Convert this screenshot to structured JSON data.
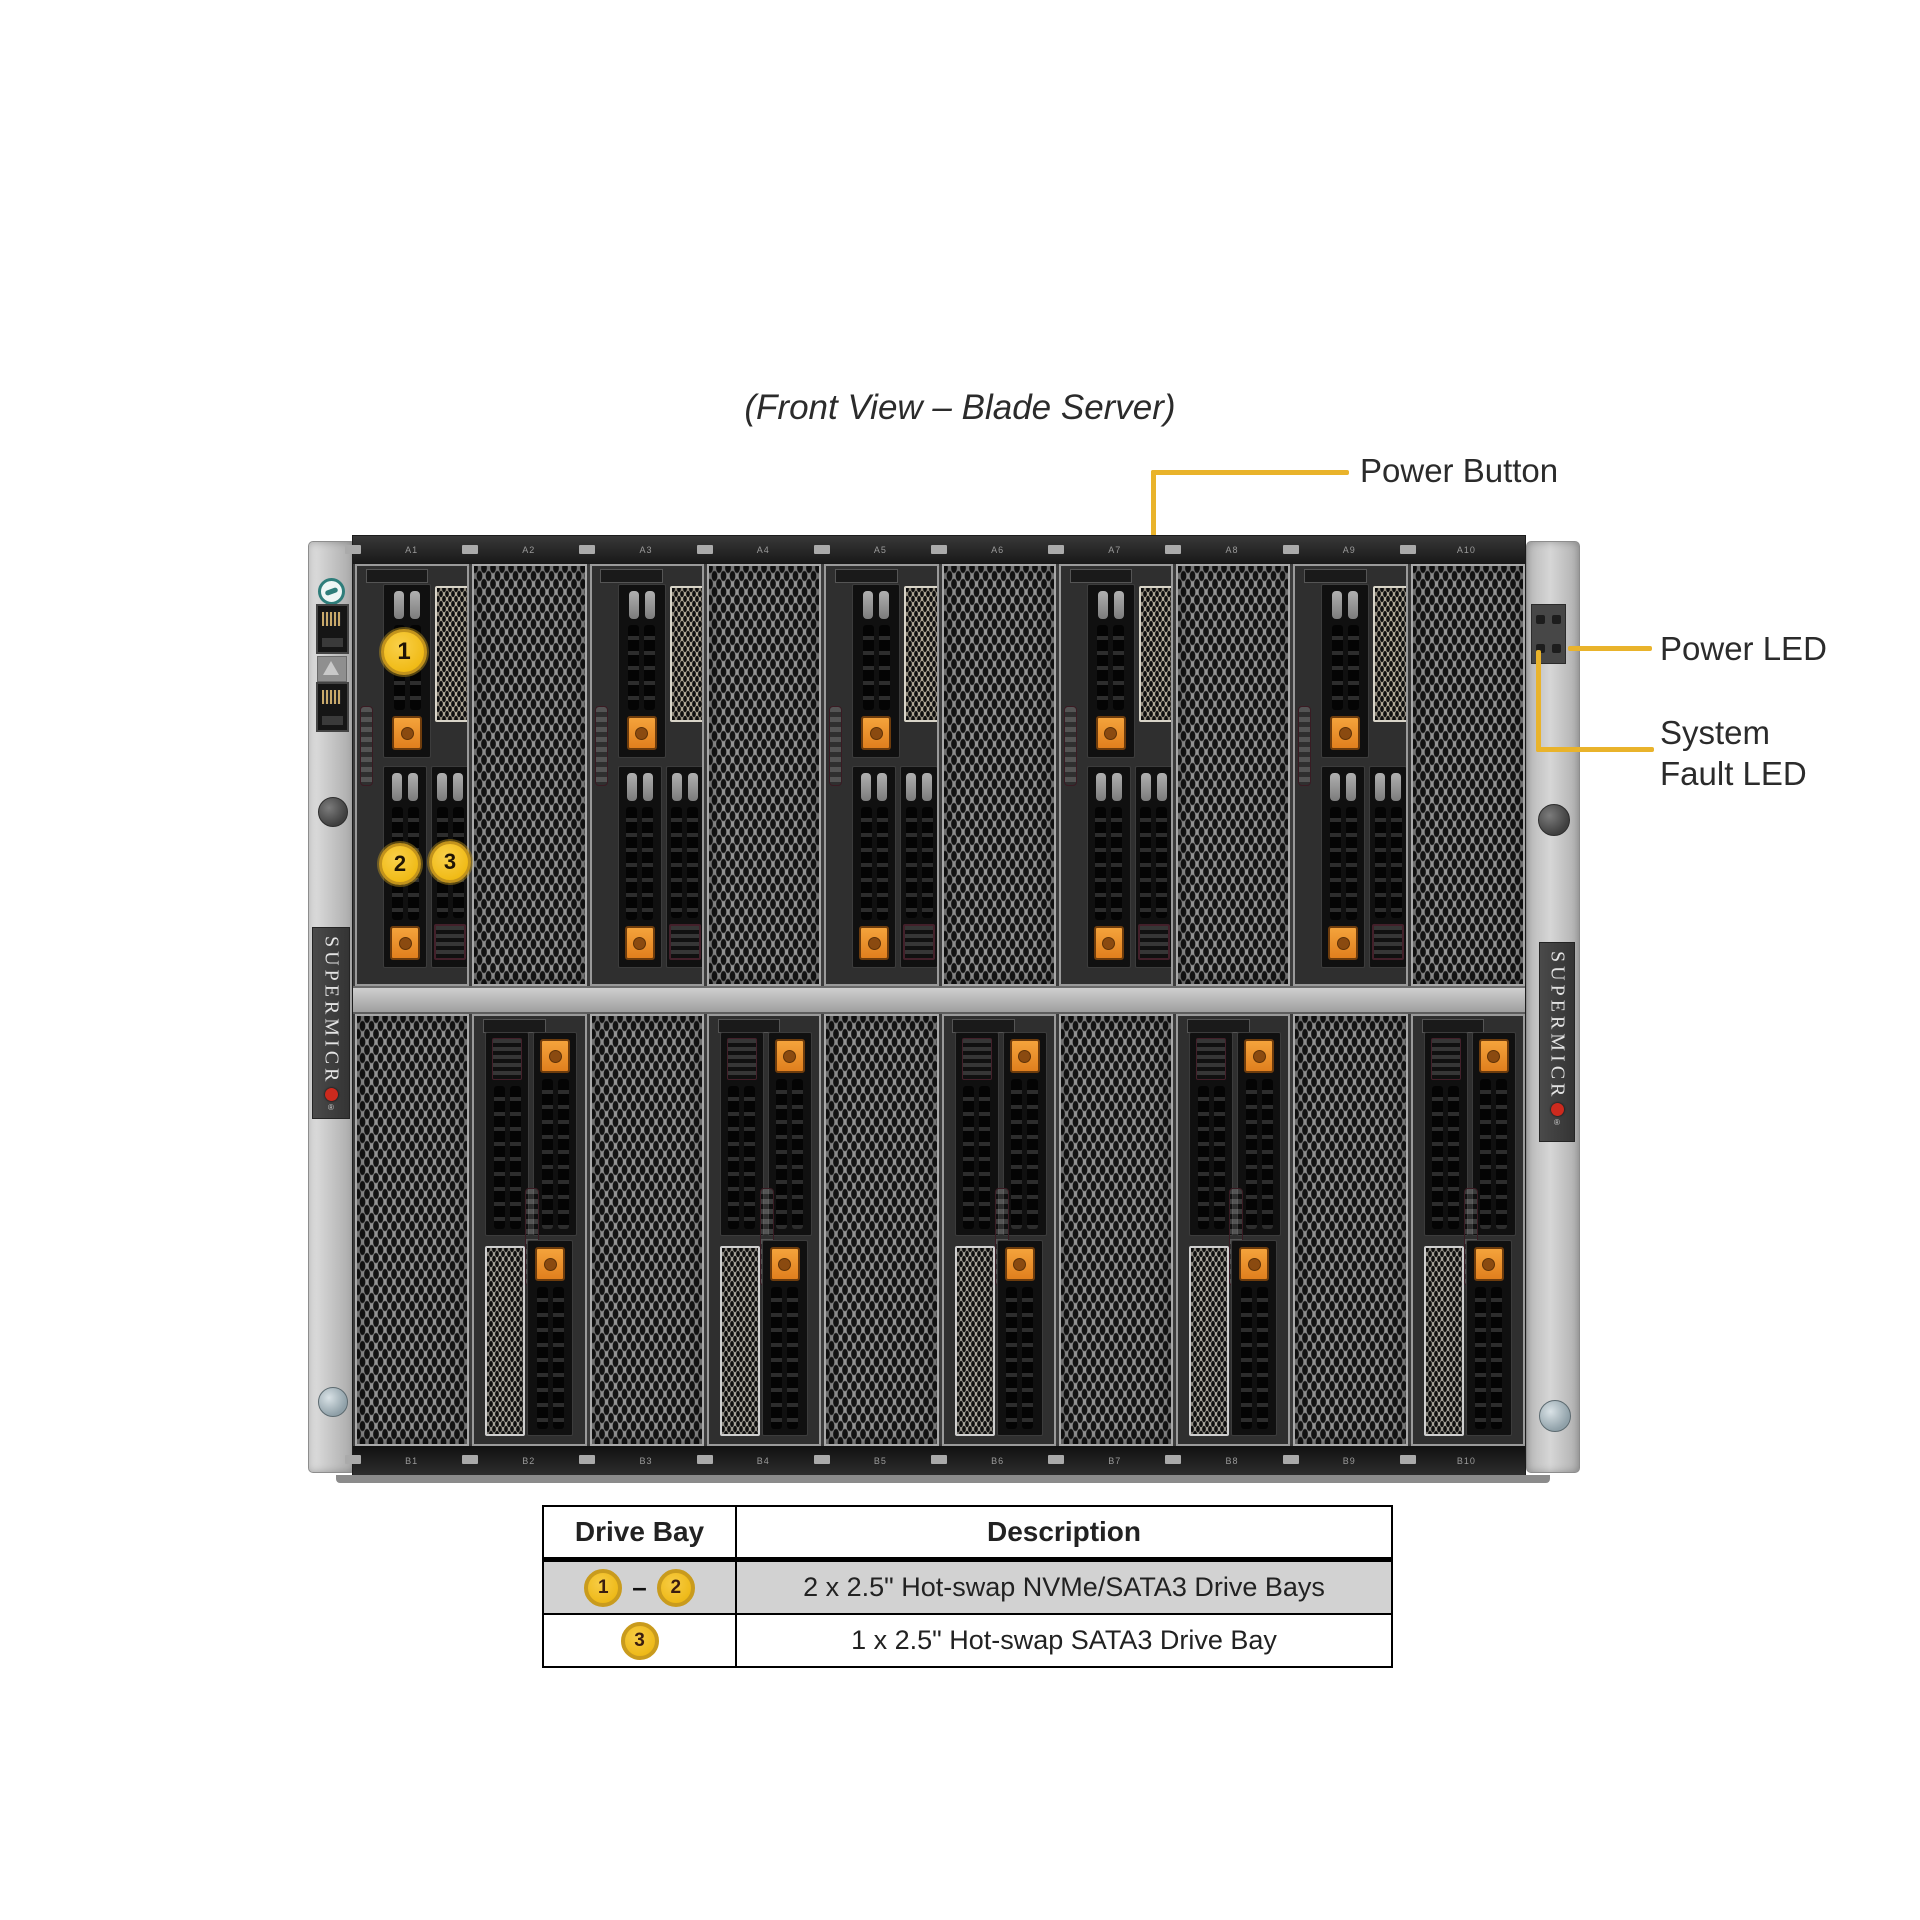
{
  "title": "(Front View – Blade Server)",
  "callouts": {
    "power_button": "Power Button",
    "power_led": "Power LED",
    "system_fault_line1": "System",
    "system_fault_line2": "Fault LED"
  },
  "markers": [
    "1",
    "2",
    "3"
  ],
  "brand": {
    "text": "SUPERMICR",
    "dot": "",
    "reg": "®"
  },
  "chassis": {
    "top_slots": [
      {
        "label": "A1",
        "type": "blade"
      },
      {
        "label": "A2",
        "type": "mesh"
      },
      {
        "label": "A3",
        "type": "blade"
      },
      {
        "label": "A4",
        "type": "mesh"
      },
      {
        "label": "A5",
        "type": "blade"
      },
      {
        "label": "A6",
        "type": "mesh"
      },
      {
        "label": "A7",
        "type": "blade"
      },
      {
        "label": "A8",
        "type": "mesh"
      },
      {
        "label": "A9",
        "type": "blade"
      },
      {
        "label": "A10",
        "type": "mesh"
      }
    ],
    "bottom_slots": [
      {
        "label": "B1",
        "type": "mesh"
      },
      {
        "label": "B2",
        "type": "blade"
      },
      {
        "label": "B3",
        "type": "mesh"
      },
      {
        "label": "B4",
        "type": "blade"
      },
      {
        "label": "B5",
        "type": "mesh"
      },
      {
        "label": "B6",
        "type": "blade"
      },
      {
        "label": "B7",
        "type": "mesh"
      },
      {
        "label": "B8",
        "type": "blade"
      },
      {
        "label": "B9",
        "type": "mesh"
      },
      {
        "label": "B10",
        "type": "blade"
      }
    ]
  },
  "table": {
    "headers": [
      "Drive Bay",
      "Description"
    ],
    "rows": [
      {
        "bays": [
          "1",
          "2"
        ],
        "separator": "–",
        "description": "2 x 2.5\" Hot-swap NVMe/SATA3 Drive Bays"
      },
      {
        "bays": [
          "3"
        ],
        "separator": "",
        "description": "1 x 2.5\" Hot-swap SATA3 Drive Bay"
      }
    ]
  },
  "colors": {
    "callout_yellow": "#e9b32b",
    "marker_yellow": "#f0ba14",
    "button_orange": "#ee8d2b",
    "lever_maroon": "#7d4450",
    "brand_red": "#cc2a1e"
  }
}
